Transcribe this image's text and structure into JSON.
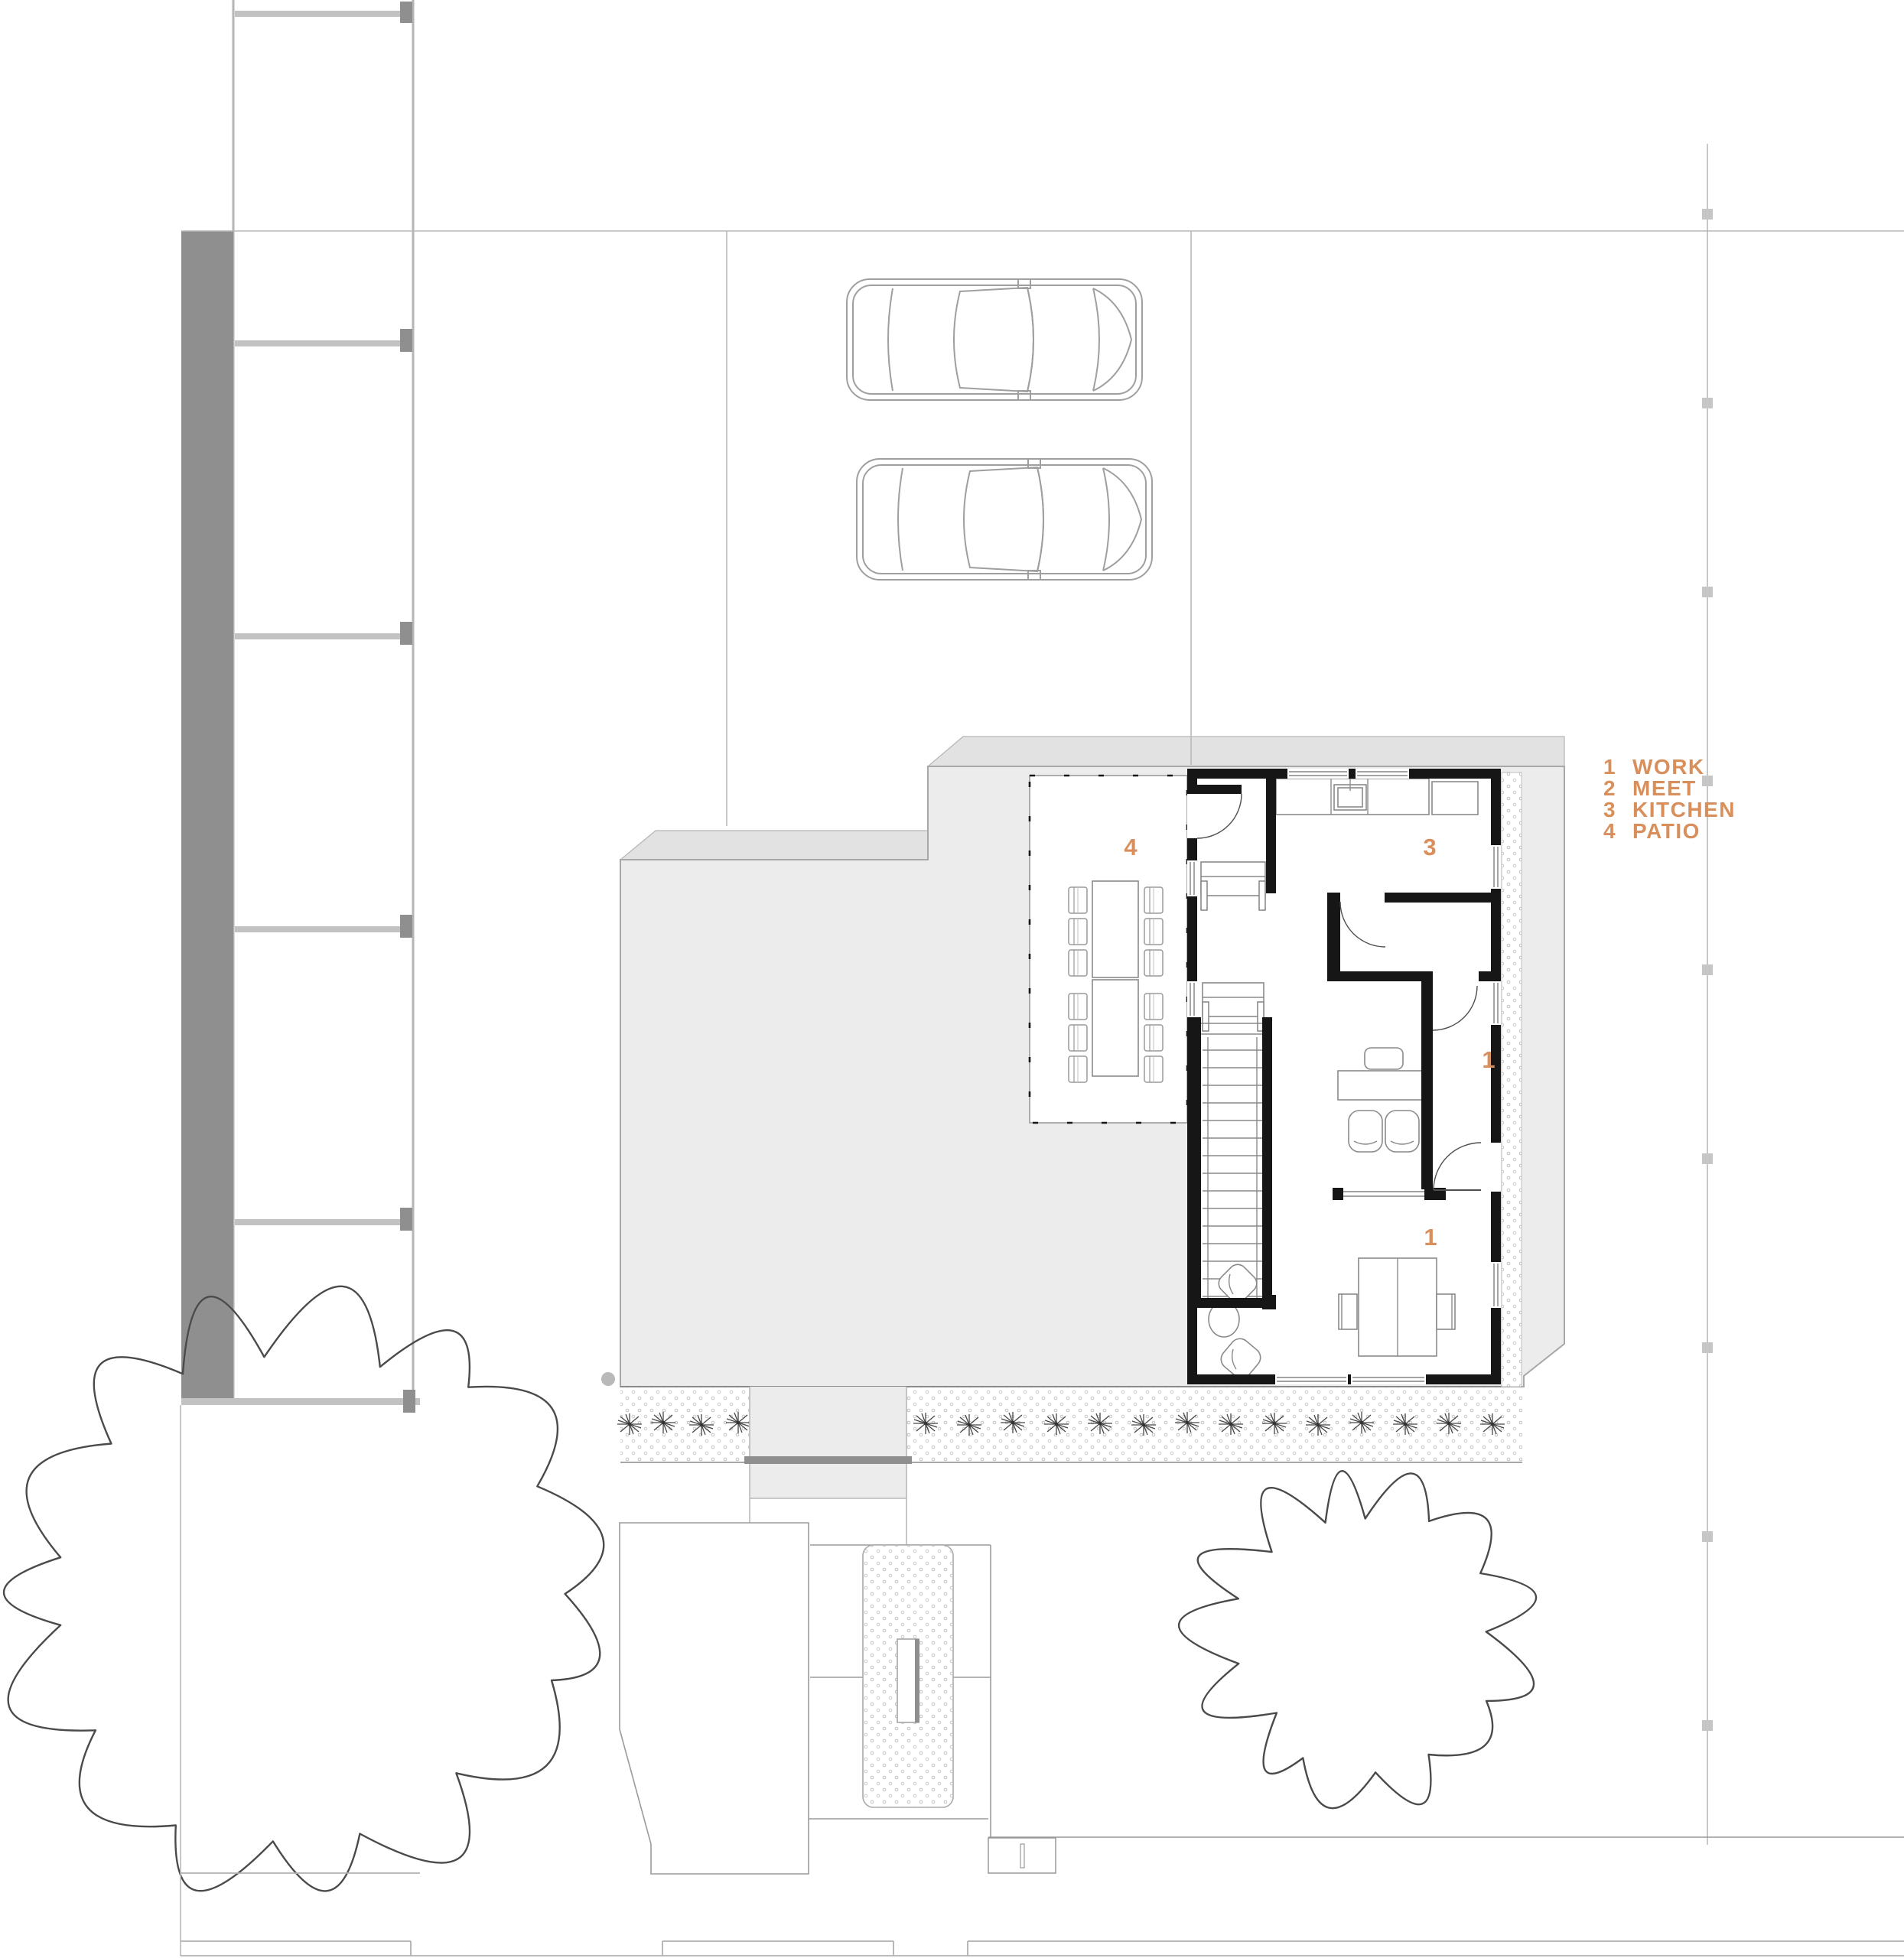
{
  "legend": {
    "items": [
      {
        "num": "1",
        "label": "WORK"
      },
      {
        "num": "2",
        "label": "MEET"
      },
      {
        "num": "3",
        "label": "KITCHEN"
      },
      {
        "num": "4",
        "label": "PATIO"
      }
    ]
  },
  "plan": {
    "room_labels": {
      "patio": "4",
      "kitchen": "3",
      "work_wall": "1",
      "work_room": "1"
    }
  },
  "colors": {
    "accent": "#D98F5B",
    "wall": "#161616",
    "slab": "#ECECEC",
    "slab_bevel": "#E2E2E2",
    "slab_border": "#A8A8A8",
    "party_wall": "#8F8F8F",
    "site_line": "#B9B9B9",
    "tree_line": "#4A4A4A",
    "car_line": "#9F9F9F",
    "furniture_line": "#8A8A8A"
  }
}
